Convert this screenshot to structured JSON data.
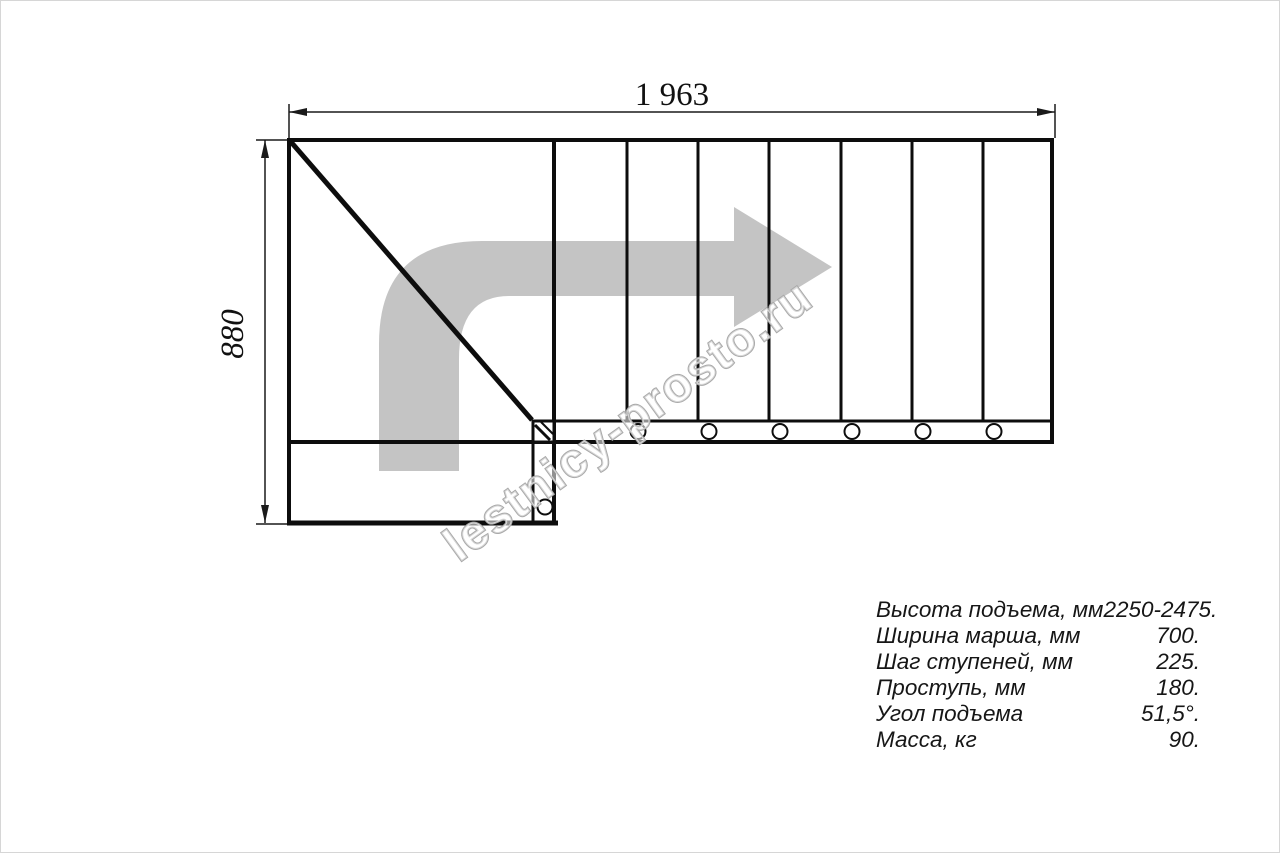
{
  "drawing": {
    "width_dim": "1 963",
    "height_dim": "880",
    "watermark": "lestnicy-prosto.ru"
  },
  "specs": {
    "rows": [
      {
        "label": "Высота подъема, мм",
        "value": "2250-2475."
      },
      {
        "label": "Ширина марша, мм",
        "value": "700."
      },
      {
        "label": "Шаг ступеней, мм",
        "value": "225."
      },
      {
        "label": "Проступь, мм",
        "value": "180."
      },
      {
        "label": "Угол подъема",
        "value": "51,5°."
      },
      {
        "label": "Масса, кг",
        "value": "90."
      }
    ]
  },
  "colors": {
    "line": "#0d0d0d",
    "dimension_line": "#1a1a1a",
    "travel_arrow": "#c4c4c4",
    "watermark_outline": "#a9a9a9",
    "background": "#ffffff"
  }
}
